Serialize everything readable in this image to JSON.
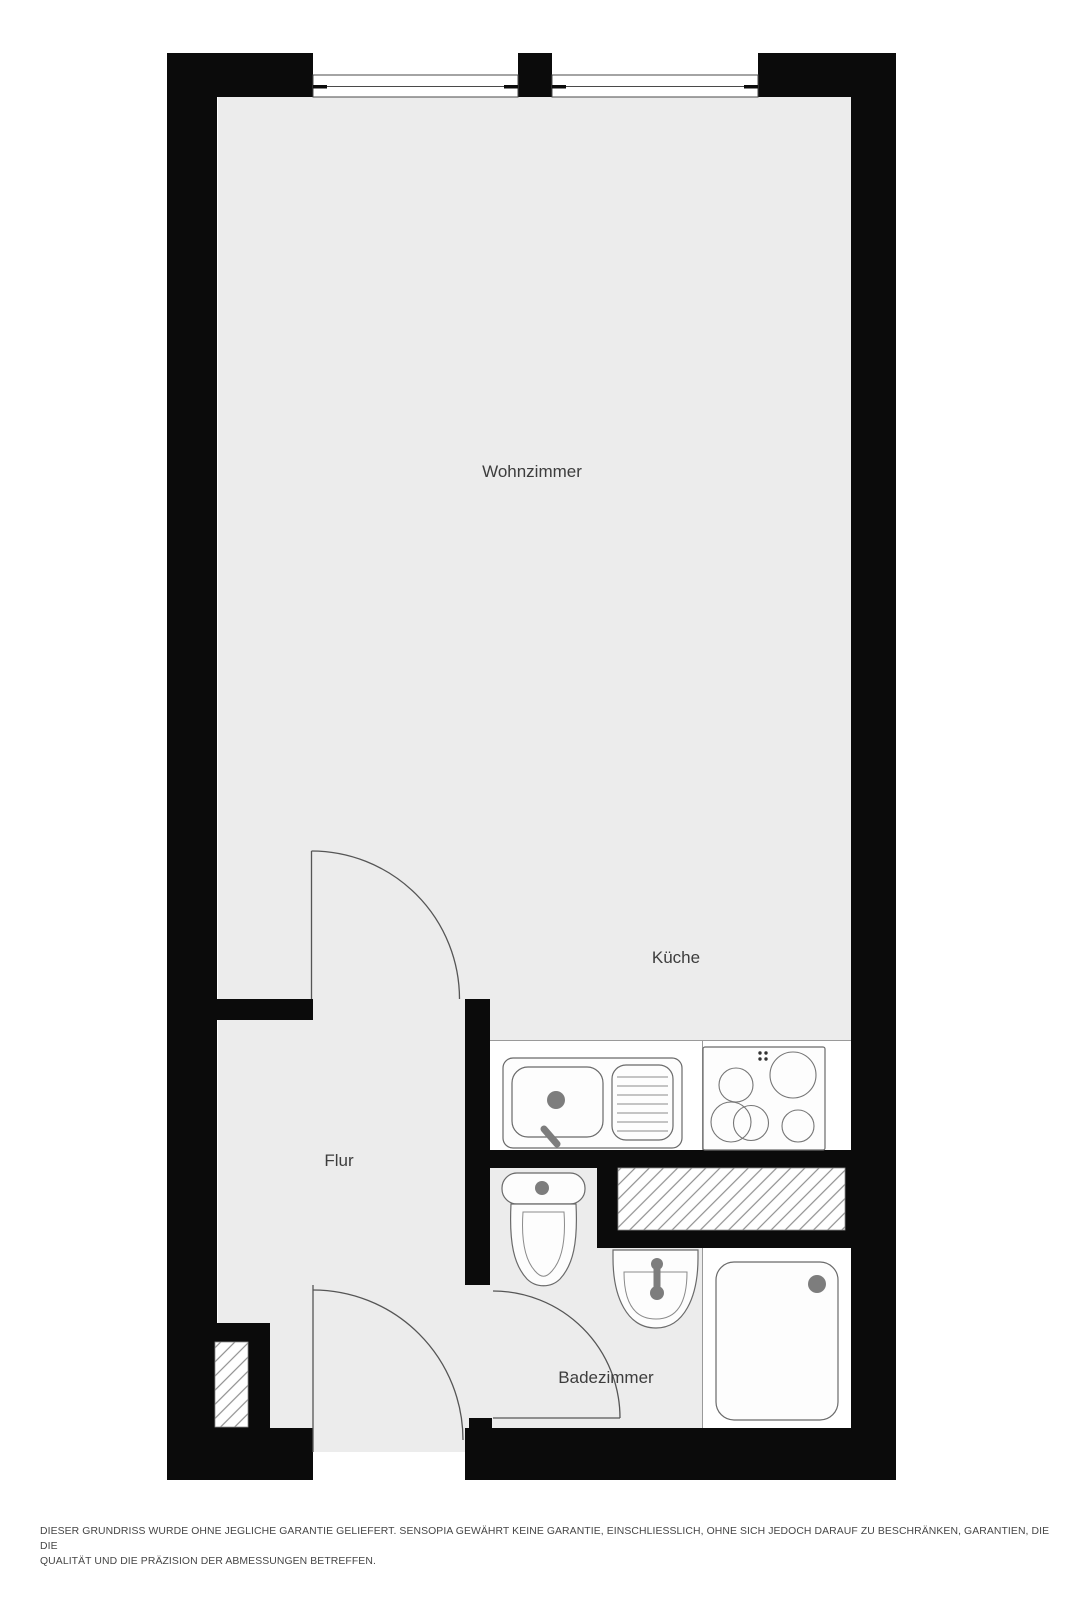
{
  "colors": {
    "wall": "#0b0b0b",
    "floor": "#ececec",
    "fixture-fill": "#fdfdfd",
    "fixture-stroke": "#6a6a6a",
    "door-stroke": "#555555",
    "hatch-line": "#8f8f8f",
    "knob-gray": "#7d7d7d",
    "label-color": "#3d3d3d",
    "disclaimer-color": "#454545"
  },
  "rooms": {
    "wohnzimmer": "Wohnzimmer",
    "kueche": "Küche",
    "flur": "Flur",
    "badezimmer": "Badezimmer"
  },
  "fixtures": {
    "kitchen_sink": "kitchen-sink-with-drainboard",
    "stove": "cooktop-4-burners",
    "toilet": "toilet",
    "washbasin": "washbasin",
    "shower": "shower-tray",
    "shaft": "hatched-shaft",
    "windows": "double-line-windows",
    "doors": "door-swing-arcs"
  },
  "disclaimer": {
    "line1": "DIESER GRUNDRISS WURDE OHNE JEGLICHE GARANTIE GELIEFERT. SENSOPIA GEWÄHRT KEINE GARANTIE, EINSCHLIESSLICH, OHNE SICH JEDOCH DARAUF ZU BESCHRÄNKEN, GARANTIEN, DIE DIE",
    "line2": "QUALITÄT UND DIE PRÄZISION DER ABMESSUNGEN BETREFFEN."
  }
}
